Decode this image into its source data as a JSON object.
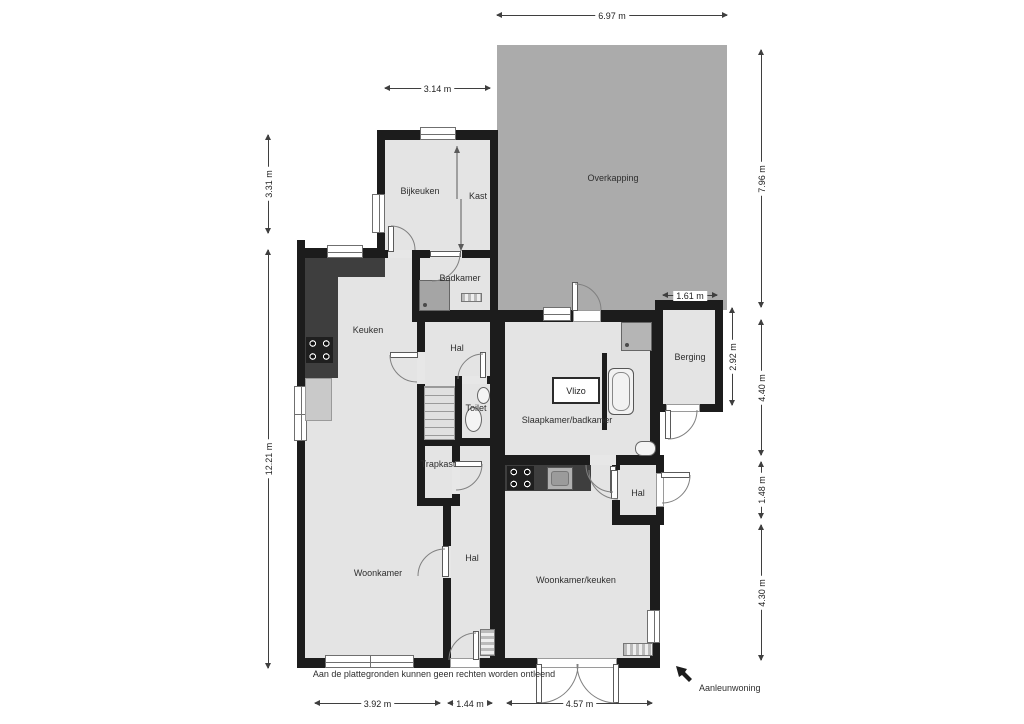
{
  "plan": {
    "disclaimer": "Aan de plattegronden kunnen geen rechten worden ontleend",
    "adjacent_building_label": "Aanleunwoning"
  },
  "rooms": [
    {
      "name": "bijkeuken",
      "label": "Bijkeuken"
    },
    {
      "name": "kast",
      "label": "Kast"
    },
    {
      "name": "overkapping",
      "label": "Overkapping"
    },
    {
      "name": "badkamer",
      "label": "Badkamer"
    },
    {
      "name": "keuken",
      "label": "Keuken"
    },
    {
      "name": "hal-boven",
      "label": "Hal"
    },
    {
      "name": "toilet",
      "label": "Toilet"
    },
    {
      "name": "trapkast",
      "label": "Trapkast"
    },
    {
      "name": "slaapkamer-badkamer",
      "label": "Slaapkamer/badkamer"
    },
    {
      "name": "vlizo-hatch",
      "label": "Vlizo"
    },
    {
      "name": "berging",
      "label": "Berging"
    },
    {
      "name": "hal-midden",
      "label": "Hal"
    },
    {
      "name": "woonkamer",
      "label": "Woonkamer"
    },
    {
      "name": "woonkamer-keuken",
      "label": "Woonkamer/keuken"
    },
    {
      "name": "hal-entree",
      "label": "Hal"
    }
  ],
  "dimensions": {
    "top": [
      {
        "label": "6.97 m"
      },
      {
        "label": "3.14 m"
      }
    ],
    "left": [
      {
        "label": "3.31 m"
      },
      {
        "label": "12.21 m"
      }
    ],
    "right": [
      {
        "label": "7.96 m"
      },
      {
        "label": "4.40 m"
      },
      {
        "label": "1.48 m"
      },
      {
        "label": "4.30 m"
      }
    ],
    "inner": [
      {
        "label": "1.61 m"
      },
      {
        "label": "2.92 m"
      }
    ],
    "bottom": [
      {
        "label": "3.92 m"
      },
      {
        "label": "1.44 m"
      },
      {
        "label": "4.57 m"
      }
    ]
  },
  "colors": {
    "wall": "#1c1c1c",
    "floor": "#e4e4e4",
    "overkapping": "#ababab",
    "counter": "#3e3e3e",
    "fixture_gray": "#a5a5a5",
    "dimension_line": "#3f3f3f"
  },
  "icons": [
    "stove-icon",
    "sink-icon",
    "shower-icon",
    "toilet-icon",
    "washbasin-icon",
    "bathtub-icon",
    "radiator-icon",
    "stairs-icon",
    "door-swing-icon",
    "window-icon",
    "sliding-door-icon",
    "direction-arrow-icon",
    "vlizo-hatch-icon"
  ]
}
